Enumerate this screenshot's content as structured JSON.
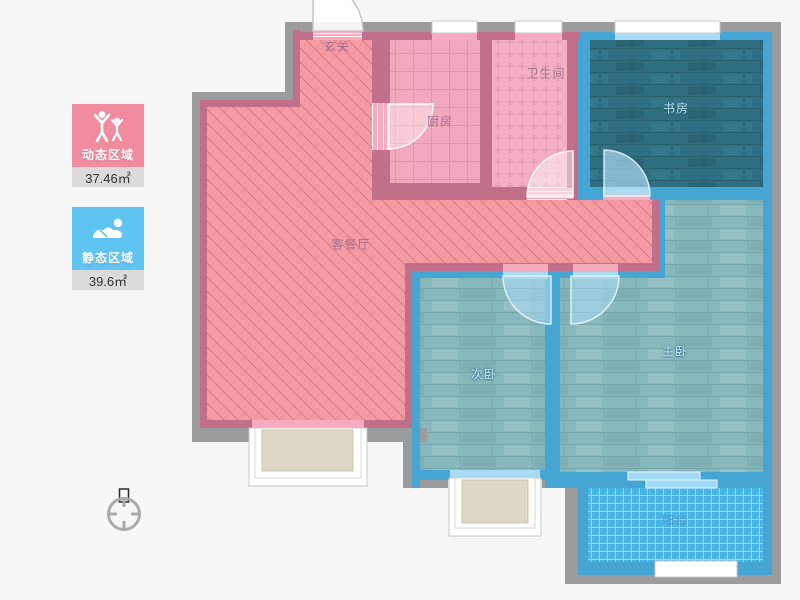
{
  "app": {
    "type": "apartment-floor-plan-viewer"
  },
  "legend": {
    "dynamic_zone": {
      "label": "动态区域",
      "area_text": "37.46㎡",
      "color": "#F08BA0",
      "icon": "people-active-icon"
    },
    "static_zone": {
      "label": "静态区域",
      "area_text": "39.6㎡",
      "color": "#5FC4F2",
      "icon": "person-resting-icon"
    }
  },
  "compass": {
    "icon": "north-compass-icon",
    "direction_label": "北"
  },
  "rooms": [
    {
      "id": "entrance",
      "label": "玄关",
      "zone": "dynamic"
    },
    {
      "id": "kitchen",
      "label": "厨房",
      "zone": "dynamic"
    },
    {
      "id": "bathroom",
      "label": "卫生间",
      "zone": "dynamic"
    },
    {
      "id": "study",
      "label": "书房",
      "zone": "static"
    },
    {
      "id": "living-dining",
      "label": "客餐厅",
      "zone": "dynamic"
    },
    {
      "id": "second-bedroom",
      "label": "次卧",
      "zone": "static"
    },
    {
      "id": "master-bedroom",
      "label": "主卧",
      "zone": "static"
    },
    {
      "id": "balcony",
      "label": "阳台",
      "zone": "static"
    }
  ],
  "colors": {
    "background": "#F7F7F7",
    "outer_wall": "#9C9C9C",
    "pink_wall": "#C16F8A",
    "blue_wall": "#45A6D4",
    "living_floor": "#F59BA3",
    "kitchen_floor": "#F3A9BD",
    "bathroom_floor": "#F5AFC2",
    "study_floor": "#306F81",
    "bedroom_floor": "#87B8BC",
    "balcony_floor": "#49B5E3",
    "window_sill_pink": "#F6ABBF",
    "window_sill_blue": "#A9DCF2",
    "bay_window_panel": "#DFD8C6"
  }
}
